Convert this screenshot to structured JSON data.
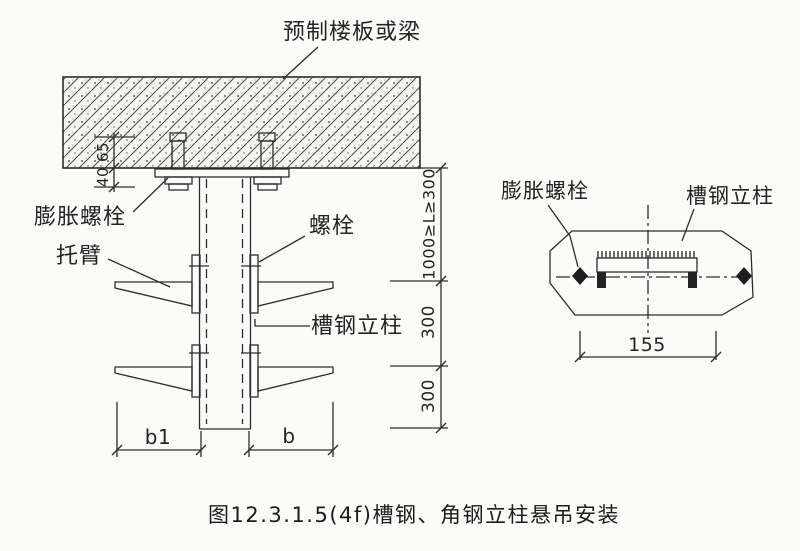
{
  "caption": "图12.3.1.5(4f)槽钢、角钢立柱悬吊安装",
  "left_view": {
    "labels": {
      "slab": "预制楼板或梁",
      "expansion_bolt": "膨胀螺栓",
      "bracket_arm": "托臂",
      "bolt": "螺栓",
      "channel_column": "槽钢立柱"
    },
    "dims": {
      "embed_depth": "65",
      "protrusion": "40",
      "hang_range": "1000≥L≥300",
      "spacing_1": "300",
      "spacing_2": "300",
      "left_width": "b1",
      "right_width": "b"
    }
  },
  "right_view": {
    "labels": {
      "expansion_bolt": "膨胀螺栓",
      "channel_column": "槽钢立柱"
    },
    "dims": {
      "bolt_spacing": "155"
    }
  },
  "colors": {
    "line": "#2c2c2c",
    "background": "#fbfbf9"
  }
}
